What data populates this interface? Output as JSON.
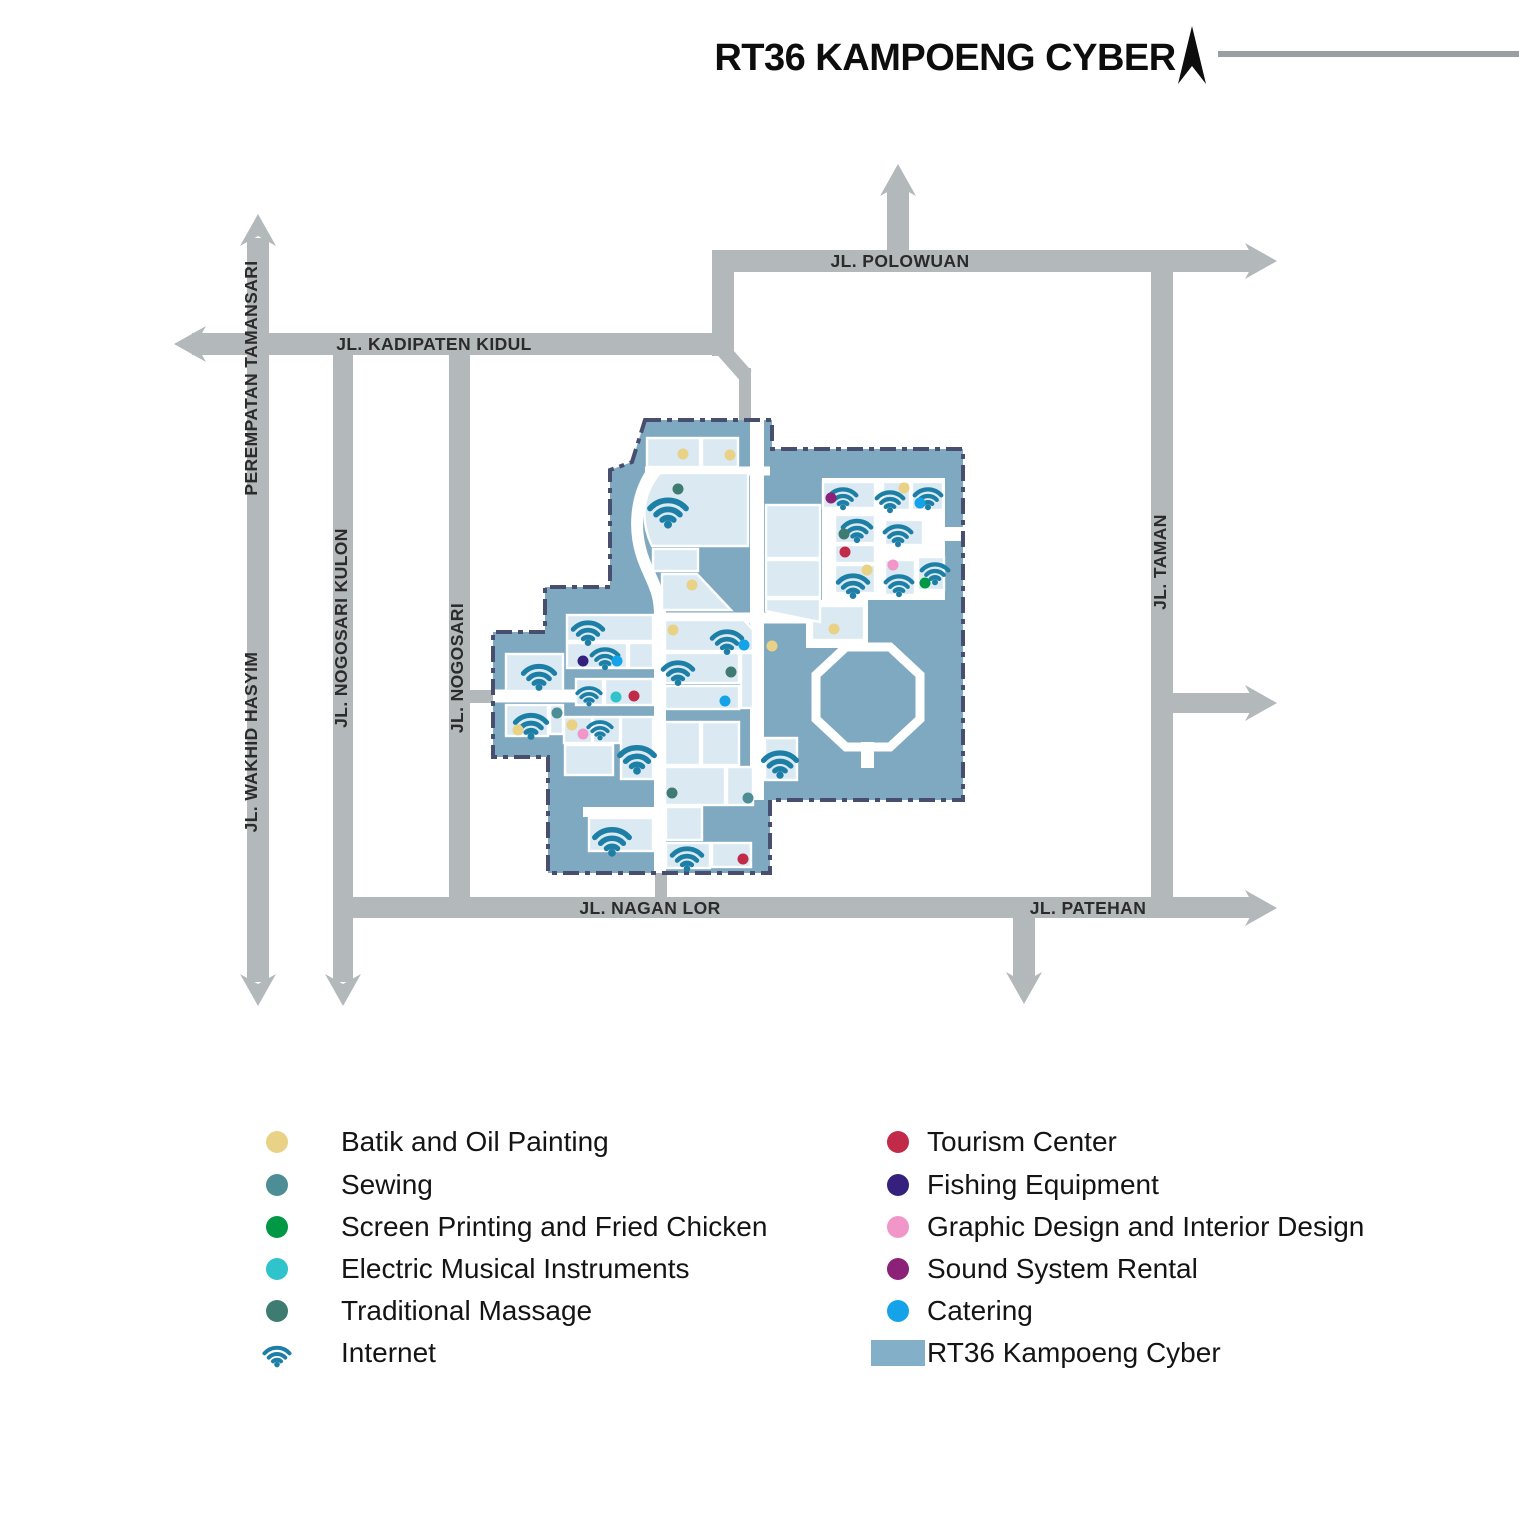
{
  "title": "RT36 KAMPOENG CYBER",
  "north_arrow_icon": "north-compass-arrow-icon",
  "colors": {
    "map_area": "#7FA9C1",
    "building": "#DBE9F3",
    "building_stroke": "#FFFFFF",
    "border": "#474E6E",
    "road": "#B3B9BB",
    "road_label": "#2B2B2B",
    "wifi": "#1E7FA6",
    "title_line": "#9AA0A2",
    "batik": "#E9D286",
    "sewing": "#4D8D95",
    "screen": "#009845",
    "electric": "#2FC3CB",
    "massage": "#3E7B70",
    "tourism": "#C22A49",
    "fishing": "#35217D",
    "graphic": "#F096C9",
    "sound": "#8C2277",
    "catering": "#14A3E8",
    "kampoeng_swatch": "#83AFC9"
  },
  "legend": {
    "left": [
      {
        "label": "Batik and Oil Painting",
        "type": "batik",
        "icon": "dot"
      },
      {
        "label": "Sewing",
        "type": "sewing",
        "icon": "dot"
      },
      {
        "label": "Screen Printing and Fried Chicken",
        "type": "screen",
        "icon": "dot"
      },
      {
        "label": "Electric Musical Instruments",
        "type": "electric",
        "icon": "dot"
      },
      {
        "label": "Traditional Massage",
        "type": "massage",
        "icon": "dot"
      },
      {
        "label": "Internet",
        "type": "wifi",
        "icon": "wifi-icon"
      }
    ],
    "right": [
      {
        "label": "Tourism Center",
        "type": "tourism",
        "icon": "dot"
      },
      {
        "label": "Fishing Equipment",
        "type": "fishing",
        "icon": "dot"
      },
      {
        "label": "Graphic Design and Interior Design",
        "type": "graphic",
        "icon": "dot"
      },
      {
        "label": "Sound System Rental",
        "type": "sound",
        "icon": "dot"
      },
      {
        "label": "Catering",
        "type": "catering",
        "icon": "dot"
      },
      {
        "label": "RT36 Kampoeng Cyber",
        "type": "kampoeng_swatch",
        "icon": "square"
      }
    ]
  },
  "roads": {
    "labels": [
      {
        "text": "JL. KADIPATEN KIDUL",
        "x": 434,
        "y": 350,
        "rotate": 0
      },
      {
        "text": "JL. POLOWUAN",
        "x": 900,
        "y": 267,
        "rotate": 0
      },
      {
        "text": "JL. NAGAN LOR",
        "x": 650,
        "y": 914,
        "rotate": 0
      },
      {
        "text": "JL. PATEHAN",
        "x": 1088,
        "y": 914,
        "rotate": 0
      },
      {
        "text": "PEREMPATAN TAMANSARI",
        "x": 257,
        "y": 378,
        "rotate": -90
      },
      {
        "text": "JL. WAKHID HASYIM",
        "x": 257,
        "y": 742,
        "rotate": -90
      },
      {
        "text": "JL. NOGOSARI KULON",
        "x": 347,
        "y": 628,
        "rotate": -90
      },
      {
        "text": "JL. NOGOSARI",
        "x": 463,
        "y": 668,
        "rotate": -90
      },
      {
        "text": "JL. TAMAN",
        "x": 1166,
        "y": 562,
        "rotate": -90
      }
    ],
    "segments": [
      {
        "x": 247,
        "y": 238,
        "w": 22,
        "h": 744
      },
      {
        "x": 192,
        "y": 333,
        "w": 542,
        "h": 22
      },
      {
        "x": 333,
        "y": 344,
        "w": 20,
        "h": 638
      },
      {
        "x": 449,
        "y": 344,
        "w": 21,
        "h": 574
      },
      {
        "x": 712,
        "y": 250,
        "w": 545,
        "h": 22
      },
      {
        "x": 887,
        "y": 186,
        "w": 22,
        "h": 80
      },
      {
        "x": 712,
        "y": 250,
        "w": 22,
        "h": 106
      },
      {
        "x": 739,
        "y": 368,
        "w": 12,
        "h": 57
      },
      {
        "x": 1151,
        "y": 272,
        "w": 22,
        "h": 646
      },
      {
        "x": 333,
        "y": 897,
        "w": 924,
        "h": 21
      },
      {
        "x": 1162,
        "y": 693,
        "w": 95,
        "h": 20
      },
      {
        "x": 1013,
        "y": 918,
        "w": 22,
        "h": 64
      },
      {
        "x": 655,
        "y": 873,
        "w": 12,
        "h": 26
      },
      {
        "x": 460,
        "y": 690,
        "w": 34,
        "h": 13
      }
    ],
    "connectors": [
      {
        "x1": 723,
        "y1": 350,
        "x2": 746,
        "y2": 376,
        "w": 15
      }
    ],
    "arrows": [
      {
        "x": 258,
        "y": 214,
        "dir": "up"
      },
      {
        "x": 898,
        "y": 164,
        "dir": "up"
      },
      {
        "x": 258,
        "y": 1006,
        "dir": "down"
      },
      {
        "x": 343,
        "y": 1006,
        "dir": "down"
      },
      {
        "x": 1024,
        "y": 1004,
        "dir": "down"
      },
      {
        "x": 174,
        "y": 344,
        "dir": "left"
      },
      {
        "x": 1277,
        "y": 261,
        "dir": "right"
      },
      {
        "x": 1277,
        "y": 703,
        "dir": "right"
      },
      {
        "x": 1277,
        "y": 908,
        "dir": "right"
      }
    ]
  },
  "map": {
    "outline": "645,420 772,420 772,449 963,449 963,800 770,800 770,873 548,873 548,757 493,757 493,632 545,632 545,587 610,587 610,470 632,462",
    "white_rects": [
      {
        "x": 822,
        "y": 478,
        "w": 123,
        "h": 122
      },
      {
        "x": 806,
        "y": 600,
        "w": 62,
        "h": 48
      },
      {
        "x": 938,
        "y": 527,
        "w": 27,
        "h": 14
      },
      {
        "x": 861,
        "y": 742,
        "w": 13,
        "h": 26
      }
    ],
    "white_paths": [
      {
        "d": "M645,471 H770",
        "w": 9
      },
      {
        "d": "M757,420 V800",
        "w": 14
      },
      {
        "d": "M656,467 C634,494 632,534 646,566 C655,587 660,594 660,616 L660,873",
        "w": 12
      },
      {
        "d": "M493,696 H665",
        "w": 13
      },
      {
        "d": "M583,812 H660",
        "w": 10
      },
      {
        "d": "M655,618 H822",
        "w": 11
      }
    ],
    "octagon": {
      "points": "846,647 890,647 920,675 920,719 890,747 846,747 816,719 816,675",
      "stroke_w": 9
    },
    "buildings": [
      {
        "x": 647,
        "y": 438,
        "w": 53,
        "h": 29
      },
      {
        "x": 702,
        "y": 438,
        "w": 36,
        "h": 29
      },
      {
        "x": 653,
        "y": 549,
        "w": 45,
        "h": 22
      },
      {
        "x": 567,
        "y": 615,
        "w": 86,
        "h": 26
      },
      {
        "x": 567,
        "y": 643,
        "w": 60,
        "h": 25
      },
      {
        "x": 629,
        "y": 643,
        "w": 24,
        "h": 25
      },
      {
        "x": 506,
        "y": 654,
        "w": 57,
        "h": 37
      },
      {
        "x": 576,
        "y": 679,
        "w": 27,
        "h": 26
      },
      {
        "x": 605,
        "y": 679,
        "w": 48,
        "h": 26
      },
      {
        "x": 506,
        "y": 705,
        "w": 42,
        "h": 31
      },
      {
        "x": 550,
        "y": 705,
        "w": 13,
        "h": 29
      },
      {
        "x": 564,
        "y": 717,
        "w": 28,
        "h": 26
      },
      {
        "x": 593,
        "y": 717,
        "w": 27,
        "h": 26
      },
      {
        "x": 621,
        "y": 717,
        "w": 32,
        "h": 62
      },
      {
        "x": 565,
        "y": 745,
        "w": 48,
        "h": 30
      },
      {
        "x": 589,
        "y": 818,
        "w": 64,
        "h": 33
      },
      {
        "x": 665,
        "y": 653,
        "w": 74,
        "h": 30
      },
      {
        "x": 741,
        "y": 653,
        "w": 12,
        "h": 55
      },
      {
        "x": 665,
        "y": 686,
        "w": 74,
        "h": 23
      },
      {
        "x": 665,
        "y": 722,
        "w": 35,
        "h": 43
      },
      {
        "x": 702,
        "y": 722,
        "w": 37,
        "h": 43
      },
      {
        "x": 665,
        "y": 767,
        "w": 60,
        "h": 38
      },
      {
        "x": 727,
        "y": 767,
        "w": 26,
        "h": 38
      },
      {
        "x": 666,
        "y": 807,
        "w": 36,
        "h": 33
      },
      {
        "x": 666,
        "y": 843,
        "w": 44,
        "h": 25
      },
      {
        "x": 712,
        "y": 843,
        "w": 39,
        "h": 24
      },
      {
        "x": 766,
        "y": 505,
        "w": 54,
        "h": 53
      },
      {
        "x": 766,
        "y": 560,
        "w": 54,
        "h": 37
      },
      {
        "x": 812,
        "y": 606,
        "w": 52,
        "h": 34
      },
      {
        "x": 765,
        "y": 738,
        "w": 32,
        "h": 42
      },
      {
        "x": 823,
        "y": 482,
        "w": 52,
        "h": 26
      },
      {
        "x": 883,
        "y": 482,
        "w": 27,
        "h": 28
      },
      {
        "x": 912,
        "y": 482,
        "w": 31,
        "h": 28
      },
      {
        "x": 835,
        "y": 515,
        "w": 40,
        "h": 28
      },
      {
        "x": 885,
        "y": 520,
        "w": 38,
        "h": 25
      },
      {
        "x": 835,
        "y": 545,
        "w": 40,
        "h": 18
      },
      {
        "x": 835,
        "y": 565,
        "w": 40,
        "h": 28
      },
      {
        "x": 885,
        "y": 560,
        "w": 30,
        "h": 35
      },
      {
        "x": 918,
        "y": 557,
        "w": 26,
        "h": 33
      }
    ],
    "building_paths": [
      {
        "d": "M660,473 H748 V546 H652 C640,521 642,494 660,473 Z"
      },
      {
        "d": "M662,574 L697,574 L731,610 L662,610 Z"
      },
      {
        "d": "M665,620 L744,620 L753,630 L753,651 L665,651 Z"
      },
      {
        "d": "M766,599 L820,599 L820,622 L766,611 Z"
      }
    ],
    "wifi": [
      {
        "x": 668,
        "y": 508,
        "s": 46
      },
      {
        "x": 843,
        "y": 495,
        "s": 34
      },
      {
        "x": 890,
        "y": 498,
        "s": 34
      },
      {
        "x": 928,
        "y": 495,
        "s": 34
      },
      {
        "x": 857,
        "y": 527,
        "s": 36
      },
      {
        "x": 898,
        "y": 532,
        "s": 34
      },
      {
        "x": 853,
        "y": 582,
        "s": 38
      },
      {
        "x": 899,
        "y": 582,
        "s": 34
      },
      {
        "x": 935,
        "y": 570,
        "s": 34
      },
      {
        "x": 588,
        "y": 629,
        "s": 38
      },
      {
        "x": 605,
        "y": 655,
        "s": 34
      },
      {
        "x": 539,
        "y": 673,
        "s": 40
      },
      {
        "x": 589,
        "y": 693,
        "s": 30
      },
      {
        "x": 531,
        "y": 722,
        "s": 40
      },
      {
        "x": 600,
        "y": 727,
        "s": 30
      },
      {
        "x": 637,
        "y": 755,
        "s": 44
      },
      {
        "x": 727,
        "y": 638,
        "s": 38
      },
      {
        "x": 678,
        "y": 669,
        "s": 38
      },
      {
        "x": 780,
        "y": 760,
        "s": 42
      },
      {
        "x": 612,
        "y": 837,
        "s": 44
      },
      {
        "x": 687,
        "y": 855,
        "s": 38
      }
    ],
    "dots": [
      {
        "x": 683,
        "y": 454,
        "type": "batik"
      },
      {
        "x": 730,
        "y": 455,
        "type": "batik"
      },
      {
        "x": 678,
        "y": 489,
        "type": "massage"
      },
      {
        "x": 692,
        "y": 585,
        "type": "batik"
      },
      {
        "x": 831,
        "y": 498,
        "type": "sound"
      },
      {
        "x": 904,
        "y": 488,
        "type": "batik"
      },
      {
        "x": 920,
        "y": 503,
        "type": "catering"
      },
      {
        "x": 844,
        "y": 534,
        "type": "massage"
      },
      {
        "x": 845,
        "y": 552,
        "type": "tourism"
      },
      {
        "x": 867,
        "y": 570,
        "type": "batik"
      },
      {
        "x": 893,
        "y": 565,
        "type": "graphic"
      },
      {
        "x": 925,
        "y": 583,
        "type": "screen"
      },
      {
        "x": 583,
        "y": 661,
        "type": "fishing"
      },
      {
        "x": 617,
        "y": 661,
        "type": "catering"
      },
      {
        "x": 616,
        "y": 697,
        "type": "electric"
      },
      {
        "x": 634,
        "y": 696,
        "type": "tourism"
      },
      {
        "x": 518,
        "y": 730,
        "type": "batik"
      },
      {
        "x": 557,
        "y": 713,
        "type": "sewing"
      },
      {
        "x": 572,
        "y": 725,
        "type": "batik"
      },
      {
        "x": 583,
        "y": 734,
        "type": "graphic"
      },
      {
        "x": 673,
        "y": 630,
        "type": "batik"
      },
      {
        "x": 744,
        "y": 645,
        "type": "catering"
      },
      {
        "x": 731,
        "y": 672,
        "type": "massage"
      },
      {
        "x": 725,
        "y": 701,
        "type": "catering"
      },
      {
        "x": 672,
        "y": 793,
        "type": "massage"
      },
      {
        "x": 748,
        "y": 798,
        "type": "sewing"
      },
      {
        "x": 743,
        "y": 859,
        "type": "tourism"
      },
      {
        "x": 772,
        "y": 646,
        "type": "batik"
      },
      {
        "x": 834,
        "y": 629,
        "type": "batik"
      }
    ],
    "dot_radius": 5.5
  }
}
